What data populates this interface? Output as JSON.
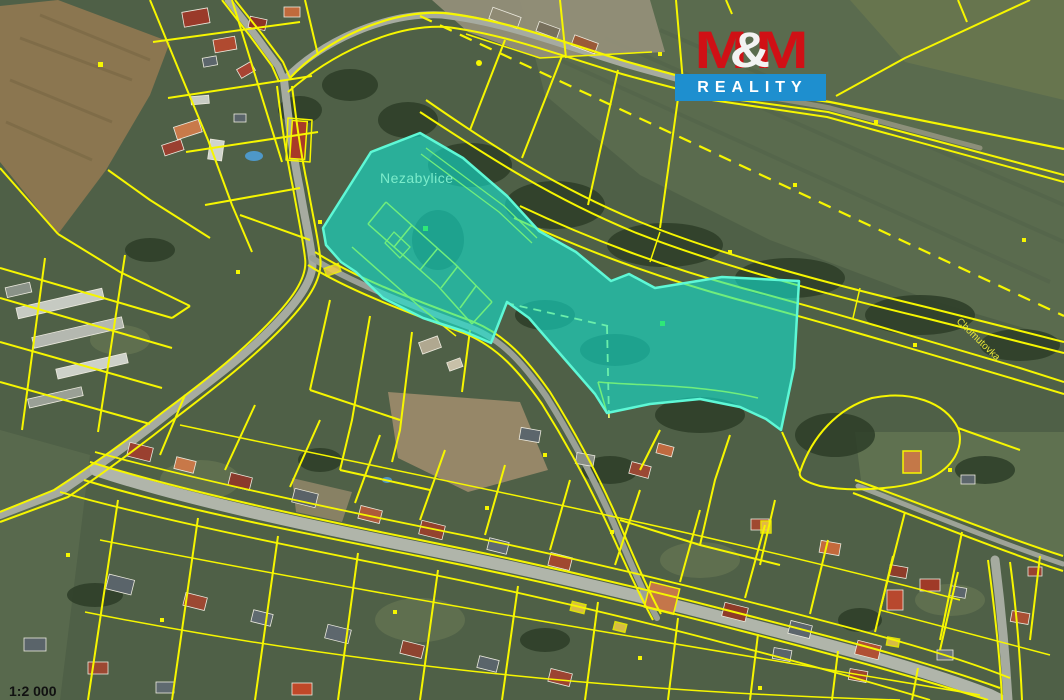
{
  "map": {
    "settlement_label": "Nezabylice",
    "watercourse_label": "Chomutovka",
    "scale_label": "1:2 000",
    "colors": {
      "parcel_line": "#f6f600",
      "highlight_fill": "#10e8d6",
      "highlight_outline": "#5ef8d6",
      "settlement_label_color": "#7ceccb",
      "watercourse_label_color": "#e8e83a",
      "scale_label_color": "#111111"
    }
  },
  "logo": {
    "m_first": "M",
    "ampersand": "&",
    "m_second": "M",
    "word_bottom": "REALITY",
    "red": "#d01015",
    "blue": "#1e8fcf",
    "white": "#f2f2f2"
  }
}
